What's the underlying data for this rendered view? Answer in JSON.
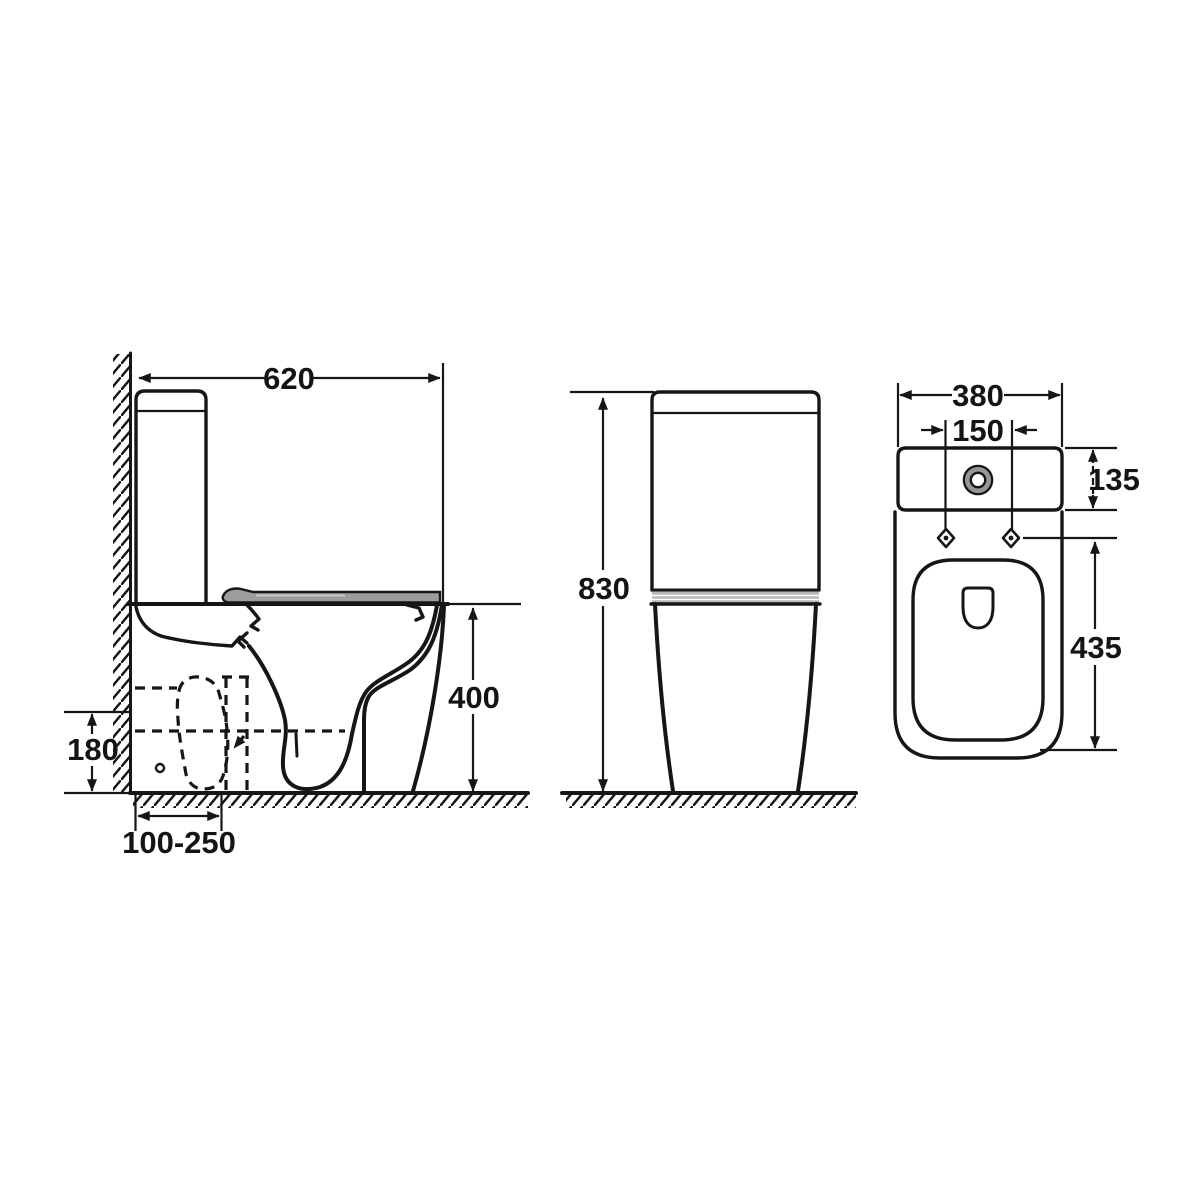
{
  "colors": {
    "line": "#161616",
    "seat_gray": "#9c9c9c",
    "seat_stripe": "#c9c9c9",
    "band_gray": "#b8b8b8",
    "ring_gray": "#969696"
  },
  "dims": {
    "depth": "620",
    "height": "830",
    "rim_height": "400",
    "outlet_height": "180",
    "outlet_setout": "100-250",
    "width": "380",
    "flush_spacing": "150",
    "cistern_depth": "135",
    "pan_length": "435"
  }
}
